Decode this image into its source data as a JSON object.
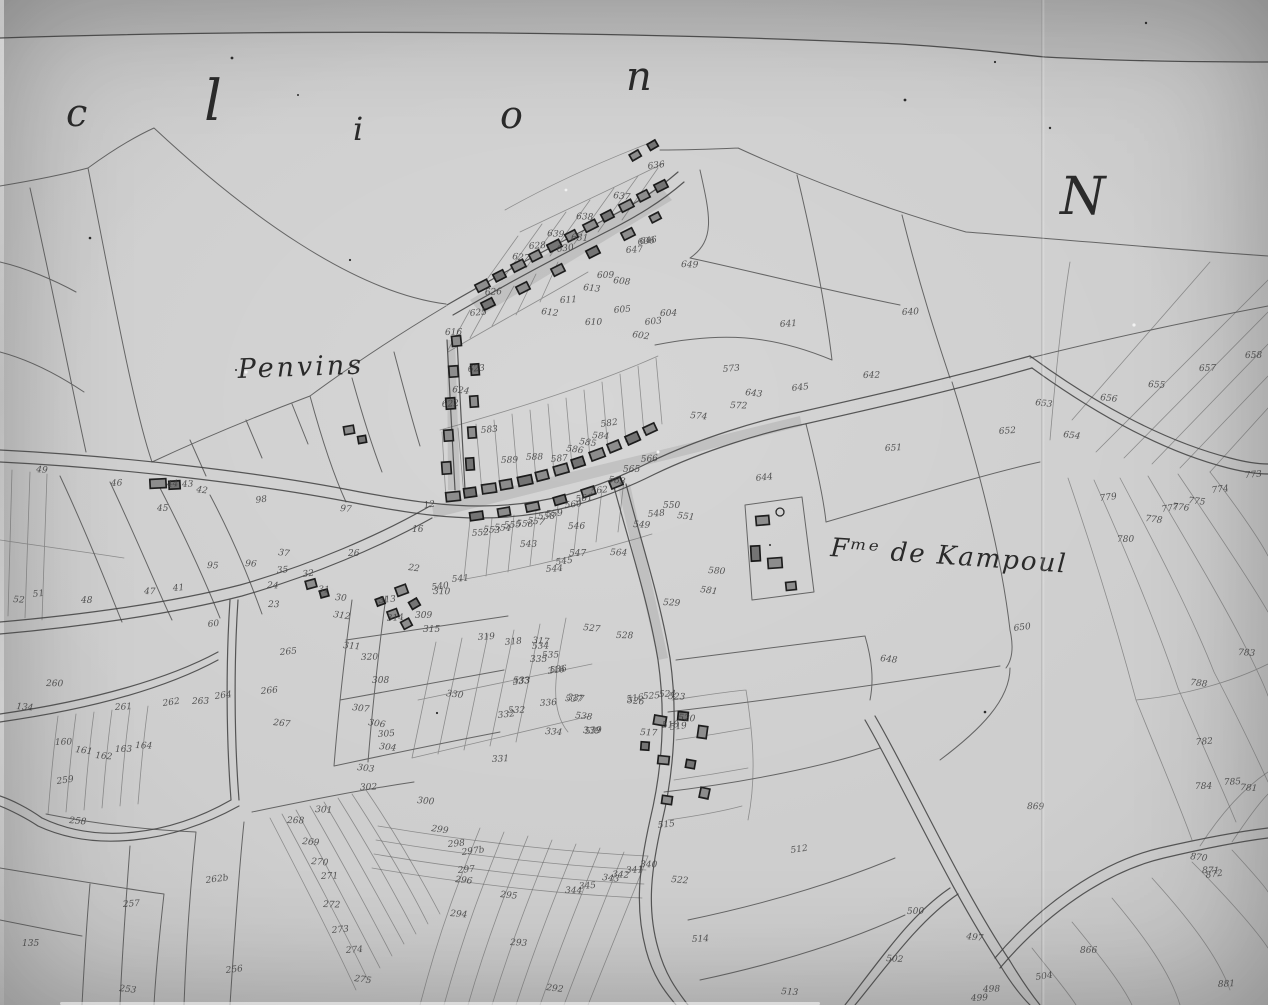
{
  "map": {
    "section_letters": [
      {
        "char": "c",
        "x": 66,
        "y": 126,
        "size": 38
      },
      {
        "char": "l",
        "x": 204,
        "y": 120,
        "size": 56
      },
      {
        "char": "i",
        "x": 353,
        "y": 140,
        "size": 32
      },
      {
        "char": "o",
        "x": 500,
        "y": 128,
        "size": 38
      },
      {
        "char": "n",
        "x": 626,
        "y": 90,
        "size": 40
      }
    ],
    "north_letter": {
      "char": "N",
      "x": 1060,
      "y": 214,
      "size": 52
    },
    "place_labels": [
      {
        "text": "Penvins",
        "x": 238,
        "y": 378,
        "size": 27,
        "spacing": 3,
        "rotate": -2
      },
      {
        "text": "Fᵐᵉ de Kampoul",
        "x": 830,
        "y": 556,
        "size": 26,
        "spacing": 2,
        "rotate": 4
      }
    ],
    "parcel_numbers": [
      {
        "t": "636",
        "x": 648,
        "y": 169
      },
      {
        "t": "637",
        "x": 613,
        "y": 198
      },
      {
        "t": "638",
        "x": 576,
        "y": 219
      },
      {
        "t": "639",
        "x": 547,
        "y": 236
      },
      {
        "t": "631",
        "x": 571,
        "y": 240
      },
      {
        "t": "630",
        "x": 557,
        "y": 252
      },
      {
        "t": "628",
        "x": 529,
        "y": 249
      },
      {
        "t": "627",
        "x": 512,
        "y": 259
      },
      {
        "t": "626",
        "x": 485,
        "y": 295
      },
      {
        "t": "625",
        "x": 470,
        "y": 316
      },
      {
        "t": "646",
        "x": 640,
        "y": 244
      },
      {
        "t": "647",
        "x": 626,
        "y": 253
      },
      {
        "t": "649",
        "x": 681,
        "y": 267
      },
      {
        "t": "611",
        "x": 560,
        "y": 303
      },
      {
        "t": "612",
        "x": 541,
        "y": 314
      },
      {
        "t": "613",
        "x": 583,
        "y": 290
      },
      {
        "t": "609",
        "x": 597,
        "y": 278
      },
      {
        "t": "608",
        "x": 613,
        "y": 283
      },
      {
        "t": "605",
        "x": 614,
        "y": 313
      },
      {
        "t": "610",
        "x": 585,
        "y": 325
      },
      {
        "t": "616",
        "x": 445,
        "y": 335
      },
      {
        "t": "622",
        "x": 442,
        "y": 407
      },
      {
        "t": "623",
        "x": 468,
        "y": 372
      },
      {
        "t": "624",
        "x": 452,
        "y": 392
      },
      {
        "t": "640",
        "x": 902,
        "y": 315
      },
      {
        "t": "641",
        "x": 780,
        "y": 327
      },
      {
        "t": "642",
        "x": 863,
        "y": 378
      },
      {
        "t": "645",
        "x": 792,
        "y": 391
      },
      {
        "t": "643",
        "x": 745,
        "y": 395
      },
      {
        "t": "602",
        "x": 632,
        "y": 337
      },
      {
        "t": "603",
        "x": 645,
        "y": 325
      },
      {
        "t": "604",
        "x": 660,
        "y": 316
      },
      {
        "t": "606",
        "x": 638,
        "y": 245
      },
      {
        "t": "572",
        "x": 730,
        "y": 408
      },
      {
        "t": "573",
        "x": 723,
        "y": 372
      },
      {
        "t": "574",
        "x": 690,
        "y": 418
      },
      {
        "t": "651",
        "x": 885,
        "y": 451
      },
      {
        "t": "652",
        "x": 999,
        "y": 434
      },
      {
        "t": "653",
        "x": 1035,
        "y": 405
      },
      {
        "t": "644",
        "x": 756,
        "y": 481
      },
      {
        "t": "648",
        "x": 880,
        "y": 661
      },
      {
        "t": "650",
        "x": 1014,
        "y": 631
      },
      {
        "t": "654",
        "x": 1063,
        "y": 437
      },
      {
        "t": "655",
        "x": 1148,
        "y": 387
      },
      {
        "t": "656",
        "x": 1100,
        "y": 400
      },
      {
        "t": "657",
        "x": 1199,
        "y": 371
      },
      {
        "t": "658",
        "x": 1245,
        "y": 358
      },
      {
        "t": "779",
        "x": 1100,
        "y": 501
      },
      {
        "t": "778",
        "x": 1145,
        "y": 521
      },
      {
        "t": "777",
        "x": 1162,
        "y": 512
      },
      {
        "t": "776",
        "x": 1172,
        "y": 509
      },
      {
        "t": "775",
        "x": 1188,
        "y": 503
      },
      {
        "t": "774",
        "x": 1212,
        "y": 493
      },
      {
        "t": "773",
        "x": 1245,
        "y": 478
      },
      {
        "t": "780",
        "x": 1117,
        "y": 542
      },
      {
        "t": "783",
        "x": 1238,
        "y": 655
      },
      {
        "t": "788",
        "x": 1190,
        "y": 685
      },
      {
        "t": "782",
        "x": 1196,
        "y": 745
      },
      {
        "t": "784",
        "x": 1195,
        "y": 789
      },
      {
        "t": "785",
        "x": 1224,
        "y": 785
      },
      {
        "t": "781",
        "x": 1240,
        "y": 790
      },
      {
        "t": "583",
        "x": 481,
        "y": 433
      },
      {
        "t": "586",
        "x": 566,
        "y": 451
      },
      {
        "t": "585",
        "x": 579,
        "y": 444
      },
      {
        "t": "584",
        "x": 592,
        "y": 438
      },
      {
        "t": "582",
        "x": 601,
        "y": 427
      },
      {
        "t": "589",
        "x": 501,
        "y": 463
      },
      {
        "t": "588",
        "x": 526,
        "y": 460
      },
      {
        "t": "587",
        "x": 551,
        "y": 462
      },
      {
        "t": "566",
        "x": 641,
        "y": 462
      },
      {
        "t": "565",
        "x": 623,
        "y": 472
      },
      {
        "t": "563",
        "x": 608,
        "y": 482
      },
      {
        "t": "562",
        "x": 591,
        "y": 494
      },
      {
        "t": "561",
        "x": 576,
        "y": 502
      },
      {
        "t": "560",
        "x": 565,
        "y": 508
      },
      {
        "t": "559",
        "x": 546,
        "y": 517
      },
      {
        "t": "558",
        "x": 538,
        "y": 519
      },
      {
        "t": "557",
        "x": 527,
        "y": 523
      },
      {
        "t": "556",
        "x": 516,
        "y": 526
      },
      {
        "t": "555",
        "x": 504,
        "y": 528
      },
      {
        "t": "554",
        "x": 494,
        "y": 530
      },
      {
        "t": "553",
        "x": 483,
        "y": 532
      },
      {
        "t": "552",
        "x": 472,
        "y": 536
      },
      {
        "t": "551",
        "x": 677,
        "y": 518
      },
      {
        "t": "550",
        "x": 663,
        "y": 508
      },
      {
        "t": "549",
        "x": 633,
        "y": 527
      },
      {
        "t": "548",
        "x": 648,
        "y": 517
      },
      {
        "t": "547",
        "x": 569,
        "y": 556
      },
      {
        "t": "546",
        "x": 568,
        "y": 529
      },
      {
        "t": "545",
        "x": 556,
        "y": 565
      },
      {
        "t": "544",
        "x": 546,
        "y": 572
      },
      {
        "t": "543",
        "x": 520,
        "y": 547
      },
      {
        "t": "541",
        "x": 452,
        "y": 582
      },
      {
        "t": "540",
        "x": 432,
        "y": 590
      },
      {
        "t": "564",
        "x": 610,
        "y": 555
      },
      {
        "t": "529",
        "x": 663,
        "y": 605
      },
      {
        "t": "528",
        "x": 616,
        "y": 638
      },
      {
        "t": "527",
        "x": 583,
        "y": 630
      },
      {
        "t": "526",
        "x": 627,
        "y": 703
      },
      {
        "t": "525",
        "x": 643,
        "y": 699
      },
      {
        "t": "524",
        "x": 659,
        "y": 697
      },
      {
        "t": "523",
        "x": 668,
        "y": 699
      },
      {
        "t": "520",
        "x": 678,
        "y": 720
      },
      {
        "t": "519",
        "x": 670,
        "y": 730
      },
      {
        "t": "518",
        "x": 662,
        "y": 728
      },
      {
        "t": "517",
        "x": 640,
        "y": 735
      },
      {
        "t": "516",
        "x": 627,
        "y": 702
      },
      {
        "t": "537",
        "x": 565,
        "y": 701
      },
      {
        "t": "536",
        "x": 550,
        "y": 673
      },
      {
        "t": "535",
        "x": 542,
        "y": 658
      },
      {
        "t": "534",
        "x": 532,
        "y": 649
      },
      {
        "t": "533",
        "x": 513,
        "y": 683
      },
      {
        "t": "532",
        "x": 508,
        "y": 713
      },
      {
        "t": "539",
        "x": 585,
        "y": 734
      },
      {
        "t": "538",
        "x": 575,
        "y": 718
      },
      {
        "t": "580",
        "x": 708,
        "y": 573
      },
      {
        "t": "581",
        "x": 700,
        "y": 592
      },
      {
        "t": "512",
        "x": 791,
        "y": 853
      },
      {
        "t": "515",
        "x": 658,
        "y": 828
      },
      {
        "t": "522",
        "x": 671,
        "y": 882
      },
      {
        "t": "514",
        "x": 692,
        "y": 942
      },
      {
        "t": "513",
        "x": 781,
        "y": 994
      },
      {
        "t": "312",
        "x": 333,
        "y": 617
      },
      {
        "t": "310",
        "x": 433,
        "y": 594
      },
      {
        "t": "313",
        "x": 379,
        "y": 603
      },
      {
        "t": "314",
        "x": 387,
        "y": 621
      },
      {
        "t": "309",
        "x": 415,
        "y": 618
      },
      {
        "t": "315",
        "x": 423,
        "y": 632
      },
      {
        "t": "311",
        "x": 343,
        "y": 648
      },
      {
        "t": "320",
        "x": 361,
        "y": 660
      },
      {
        "t": "308",
        "x": 372,
        "y": 683
      },
      {
        "t": "307",
        "x": 352,
        "y": 710
      },
      {
        "t": "306",
        "x": 368,
        "y": 725
      },
      {
        "t": "305",
        "x": 378,
        "y": 737
      },
      {
        "t": "304",
        "x": 379,
        "y": 749
      },
      {
        "t": "303",
        "x": 357,
        "y": 770
      },
      {
        "t": "302",
        "x": 360,
        "y": 790
      },
      {
        "t": "301",
        "x": 315,
        "y": 812
      },
      {
        "t": "300",
        "x": 417,
        "y": 803
      },
      {
        "t": "330",
        "x": 446,
        "y": 696
      },
      {
        "t": "333",
        "x": 513,
        "y": 685
      },
      {
        "t": "332",
        "x": 498,
        "y": 718
      },
      {
        "t": "334",
        "x": 545,
        "y": 734
      },
      {
        "t": "331",
        "x": 492,
        "y": 762
      },
      {
        "t": "317",
        "x": 532,
        "y": 643
      },
      {
        "t": "316",
        "x": 548,
        "y": 674
      },
      {
        "t": "337",
        "x": 567,
        "y": 700
      },
      {
        "t": "339",
        "x": 583,
        "y": 733
      },
      {
        "t": "336",
        "x": 540,
        "y": 706
      },
      {
        "t": "335",
        "x": 530,
        "y": 662
      },
      {
        "t": "318",
        "x": 505,
        "y": 645
      },
      {
        "t": "319",
        "x": 478,
        "y": 640
      },
      {
        "t": "340",
        "x": 640,
        "y": 867
      },
      {
        "t": "341",
        "x": 626,
        "y": 873
      },
      {
        "t": "342",
        "x": 612,
        "y": 877
      },
      {
        "t": "343",
        "x": 602,
        "y": 880
      },
      {
        "t": "344",
        "x": 565,
        "y": 893
      },
      {
        "t": "345",
        "x": 579,
        "y": 889
      },
      {
        "t": "299",
        "x": 431,
        "y": 831
      },
      {
        "t": "298",
        "x": 448,
        "y": 847
      },
      {
        "t": "297b",
        "x": 462,
        "y": 855
      },
      {
        "t": "297",
        "x": 458,
        "y": 873
      },
      {
        "t": "296",
        "x": 455,
        "y": 882
      },
      {
        "t": "295",
        "x": 500,
        "y": 897
      },
      {
        "t": "294",
        "x": 450,
        "y": 916
      },
      {
        "t": "293",
        "x": 510,
        "y": 945
      },
      {
        "t": "292",
        "x": 546,
        "y": 990
      },
      {
        "t": "49",
        "x": 36,
        "y": 472
      },
      {
        "t": "46",
        "x": 111,
        "y": 486
      },
      {
        "t": "44",
        "x": 167,
        "y": 487
      },
      {
        "t": "43",
        "x": 182,
        "y": 487
      },
      {
        "t": "42",
        "x": 196,
        "y": 492
      },
      {
        "t": "45",
        "x": 157,
        "y": 511
      },
      {
        "t": "47",
        "x": 144,
        "y": 594
      },
      {
        "t": "41",
        "x": 173,
        "y": 591
      },
      {
        "t": "52",
        "x": 13,
        "y": 602
      },
      {
        "t": "51",
        "x": 33,
        "y": 597
      },
      {
        "t": "48",
        "x": 81,
        "y": 603
      },
      {
        "t": "60",
        "x": 208,
        "y": 627
      },
      {
        "t": "37",
        "x": 278,
        "y": 555
      },
      {
        "t": "35",
        "x": 277,
        "y": 573
      },
      {
        "t": "96",
        "x": 245,
        "y": 566
      },
      {
        "t": "95",
        "x": 207,
        "y": 568
      },
      {
        "t": "98",
        "x": 256,
        "y": 503
      },
      {
        "t": "97",
        "x": 340,
        "y": 511
      },
      {
        "t": "24",
        "x": 267,
        "y": 588
      },
      {
        "t": "23",
        "x": 268,
        "y": 607
      },
      {
        "t": "32",
        "x": 303,
        "y": 577
      },
      {
        "t": "31",
        "x": 318,
        "y": 592
      },
      {
        "t": "30",
        "x": 335,
        "y": 600
      },
      {
        "t": "22",
        "x": 408,
        "y": 570
      },
      {
        "t": "26",
        "x": 348,
        "y": 556
      },
      {
        "t": "12",
        "x": 424,
        "y": 508
      },
      {
        "t": "16",
        "x": 412,
        "y": 532
      },
      {
        "t": "260",
        "x": 46,
        "y": 686
      },
      {
        "t": "134",
        "x": 16,
        "y": 709
      },
      {
        "t": "261",
        "x": 115,
        "y": 710
      },
      {
        "t": "262",
        "x": 163,
        "y": 706
      },
      {
        "t": "263",
        "x": 192,
        "y": 704
      },
      {
        "t": "264",
        "x": 215,
        "y": 699
      },
      {
        "t": "265",
        "x": 280,
        "y": 655
      },
      {
        "t": "266",
        "x": 261,
        "y": 694
      },
      {
        "t": "267",
        "x": 273,
        "y": 725
      },
      {
        "t": "259",
        "x": 57,
        "y": 784
      },
      {
        "t": "258",
        "x": 69,
        "y": 823
      },
      {
        "t": "257",
        "x": 123,
        "y": 907
      },
      {
        "t": "253",
        "x": 119,
        "y": 991
      },
      {
        "t": "135",
        "x": 22,
        "y": 946
      },
      {
        "t": "262b",
        "x": 206,
        "y": 883
      },
      {
        "t": "256",
        "x": 226,
        "y": 973
      },
      {
        "t": "268",
        "x": 287,
        "y": 823
      },
      {
        "t": "269",
        "x": 302,
        "y": 844
      },
      {
        "t": "270",
        "x": 311,
        "y": 864
      },
      {
        "t": "271",
        "x": 321,
        "y": 879
      },
      {
        "t": "272",
        "x": 323,
        "y": 907
      },
      {
        "t": "273",
        "x": 332,
        "y": 933
      },
      {
        "t": "274",
        "x": 346,
        "y": 953
      },
      {
        "t": "275",
        "x": 354,
        "y": 981
      },
      {
        "t": "160",
        "x": 55,
        "y": 745
      },
      {
        "t": "161",
        "x": 75,
        "y": 752
      },
      {
        "t": "162",
        "x": 95,
        "y": 758
      },
      {
        "t": "163",
        "x": 115,
        "y": 752
      },
      {
        "t": "164",
        "x": 135,
        "y": 748
      },
      {
        "t": "870",
        "x": 1190,
        "y": 859
      },
      {
        "t": "871",
        "x": 1202,
        "y": 873
      },
      {
        "t": "872",
        "x": 1206,
        "y": 878
      },
      {
        "t": "866",
        "x": 1080,
        "y": 953
      },
      {
        "t": "881",
        "x": 1218,
        "y": 987
      },
      {
        "t": "869",
        "x": 1027,
        "y": 809
      },
      {
        "t": "500",
        "x": 907,
        "y": 914
      },
      {
        "t": "502",
        "x": 886,
        "y": 961
      },
      {
        "t": "497",
        "x": 966,
        "y": 939
      },
      {
        "t": "498",
        "x": 983,
        "y": 992
      },
      {
        "t": "499",
        "x": 971,
        "y": 1001
      },
      {
        "t": "504",
        "x": 1036,
        "y": 980
      }
    ]
  }
}
